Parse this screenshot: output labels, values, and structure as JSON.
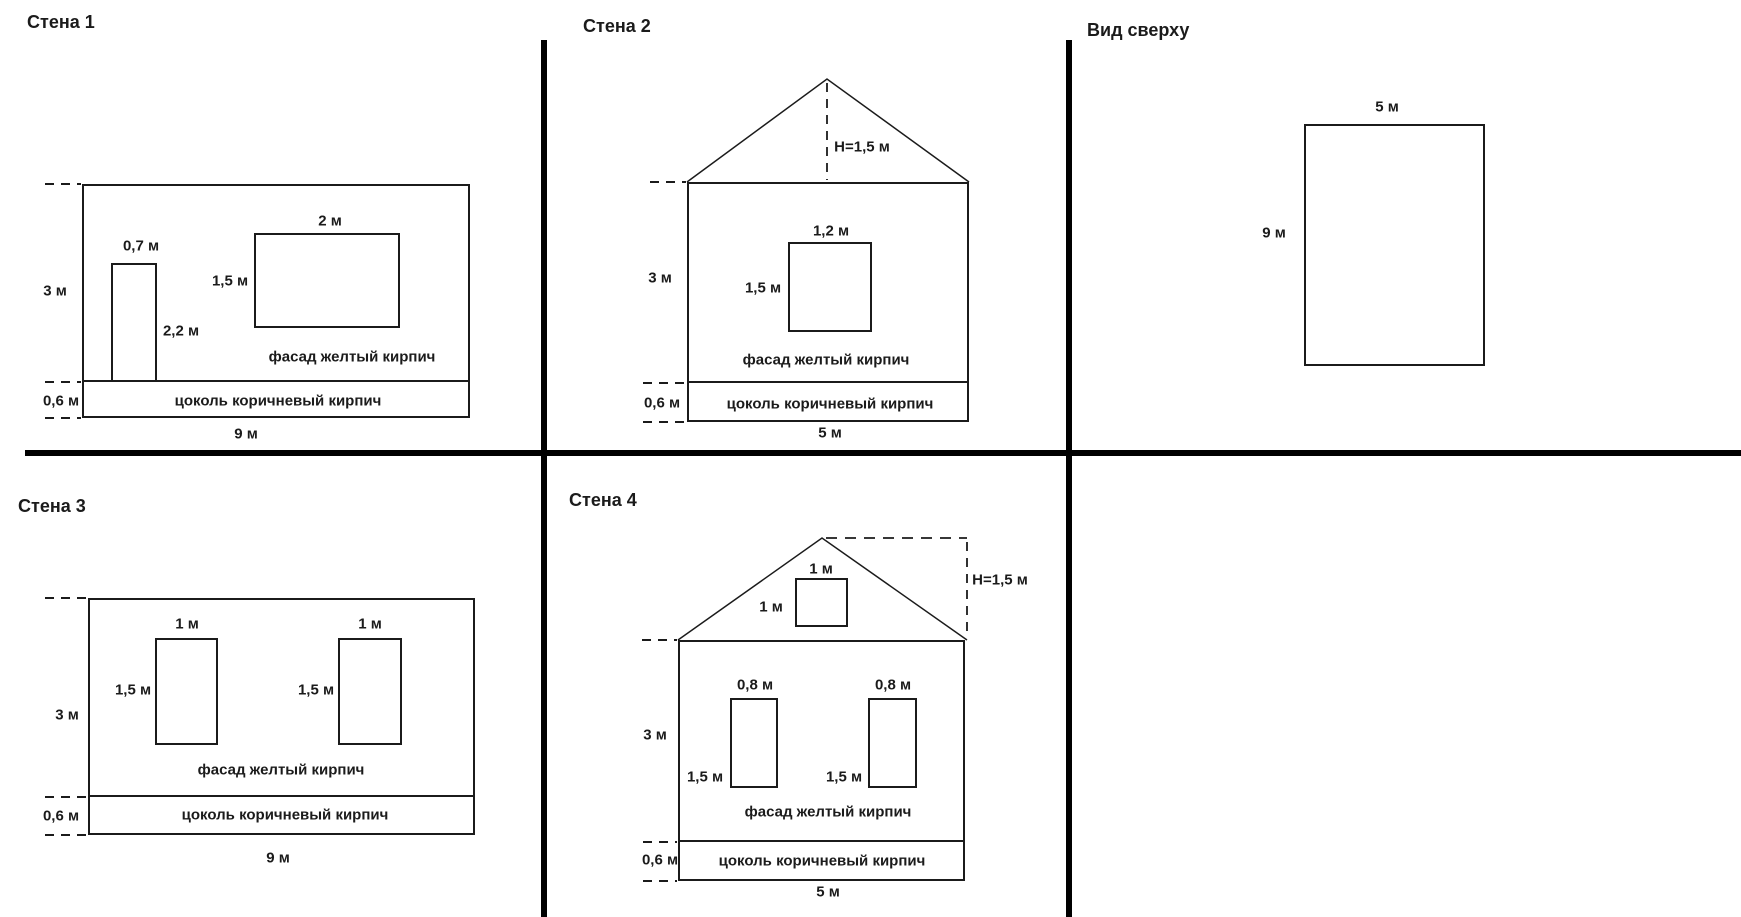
{
  "colors": {
    "line": "#1b1b1b",
    "divider": "#000000",
    "background": "#ffffff"
  },
  "panels": {
    "wall1": {
      "title": "Стена 1",
      "height_label": "3 м",
      "door_width_label": "0,7 м",
      "door_height_label": "2,2 м",
      "window_width_label": "2 м",
      "window_height_label": "1,5 м",
      "facade_label": "фасад желтый кирпич",
      "plinth_height_label": "0,6 м",
      "plinth_label": "цоколь коричневый кирпич",
      "width_label": "9 м"
    },
    "wall2": {
      "title": "Стена 2",
      "roof_height_label": "Н=1,5 м",
      "height_label": "3 м",
      "window_width_label": "1,2 м",
      "window_height_label": "1,5 м",
      "facade_label": "фасад желтый кирпич",
      "plinth_height_label": "0,6 м",
      "plinth_label": "цоколь коричневый кирпич",
      "width_label": "5 м"
    },
    "wall3": {
      "title": "Стена 3",
      "height_label": "3 м",
      "window1_width_label": "1 м",
      "window1_height_label": "1,5 м",
      "window2_width_label": "1 м",
      "window2_height_label": "1,5 м",
      "facade_label": "фасад желтый кирпич",
      "plinth_height_label": "0,6 м",
      "plinth_label": "цоколь коричневый кирпич",
      "width_label": "9 м"
    },
    "wall4": {
      "title": "Стена 4",
      "roof_height_label": "Н=1,5 м",
      "gable_window_width_label": "1 м",
      "gable_window_height_label": "1 м",
      "height_label": "3 м",
      "window1_width_label": "0,8 м",
      "window1_height_label": "1,5 м",
      "window2_width_label": "0,8 м",
      "window2_height_label": "1,5 м",
      "facade_label": "фасад желтый кирпич",
      "plinth_height_label": "0,6 м",
      "plinth_label": "цоколь коричневый кирпич",
      "width_label": "5 м"
    },
    "top_view": {
      "title": "Вид сверху",
      "width_label": "5 м",
      "height_label": "9 м"
    }
  }
}
